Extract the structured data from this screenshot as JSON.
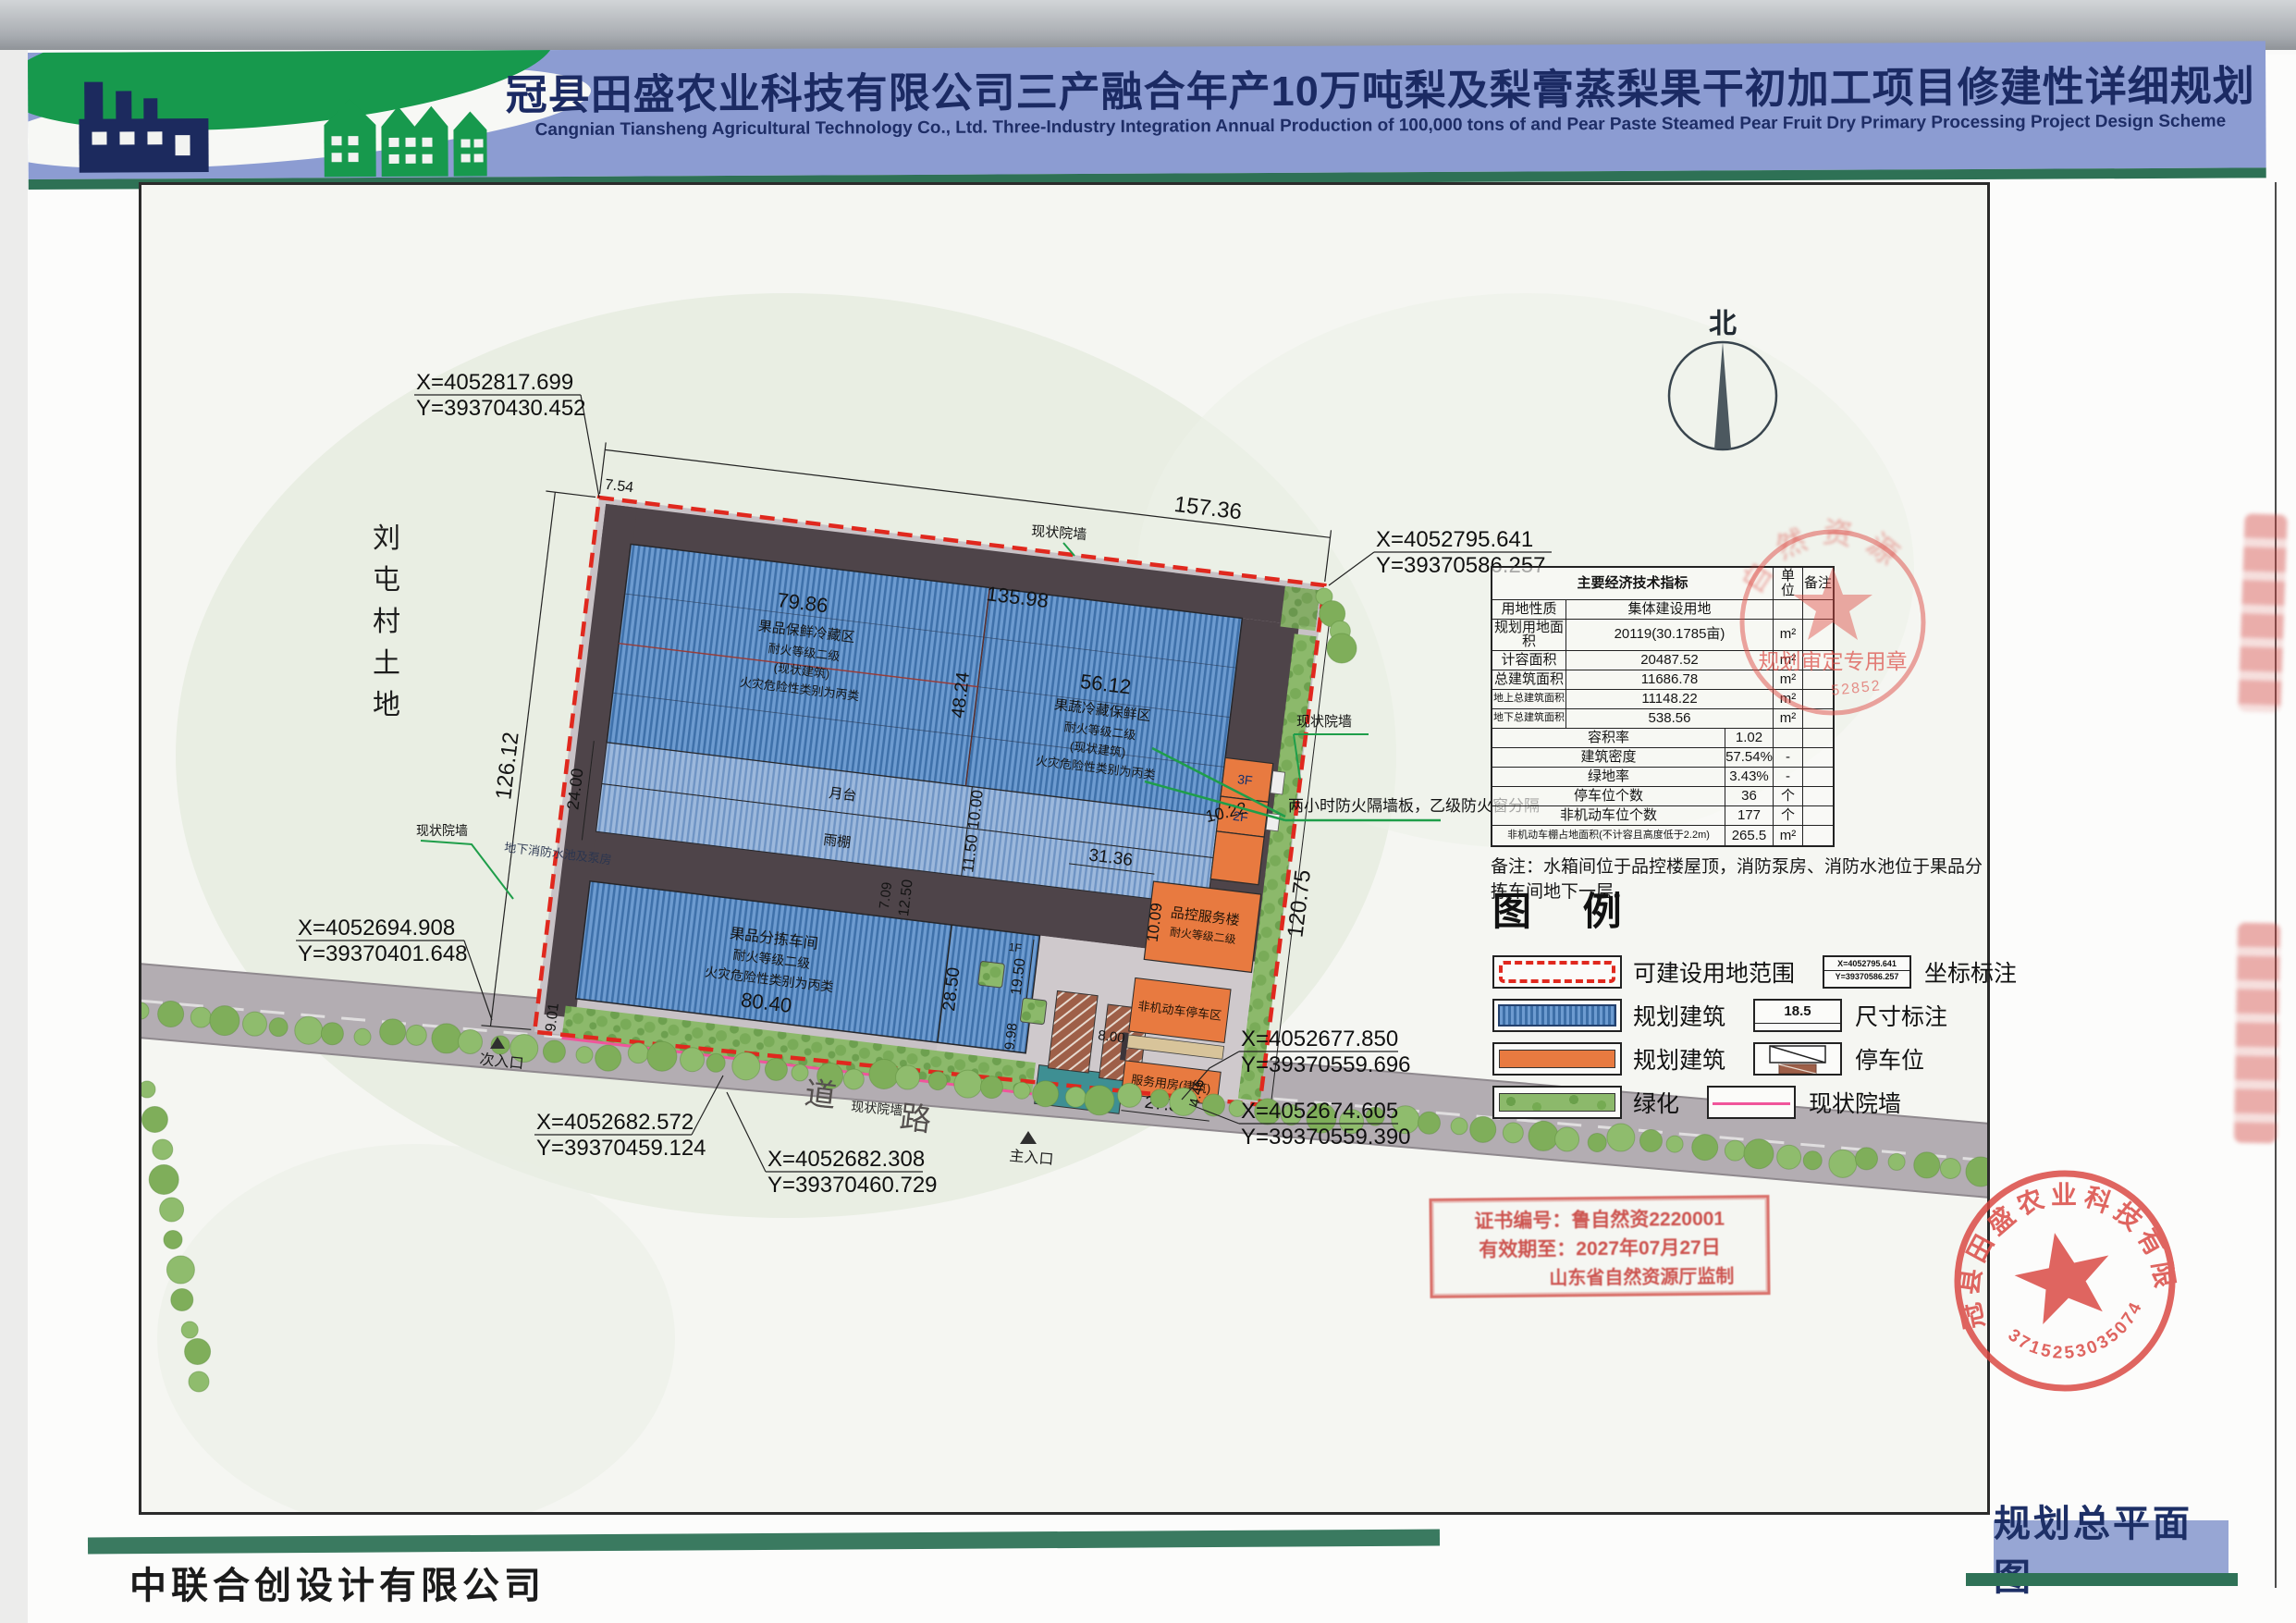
{
  "header": {
    "title": "冠县田盛农业科技有限公司三产融合年产10万吨梨及梨膏蒸梨果干初加工项目修建性详细规划",
    "subtitle": "Cangnian Tiansheng Agricultural Technology Co., Ltd. Three-Industry Integration Annual Production of 100,000 tons of and Pear Paste Steamed Pear Fruit Dry Primary Processing Project Design Scheme"
  },
  "compass": {
    "north": "北"
  },
  "table": {
    "title": "主要经济技术指标",
    "col_unit": "单位",
    "col_note": "备注",
    "rows": [
      {
        "label": "用地性质",
        "value": "集体建设用地",
        "unit": "",
        "note": ""
      },
      {
        "label": "规划用地面积",
        "value": "20119(30.1785亩)",
        "unit": "m²",
        "note": ""
      },
      {
        "label": "计容面积",
        "value": "20487.52",
        "unit": "m²",
        "note": ""
      },
      {
        "label": "总建筑面积",
        "value": "11686.78",
        "unit": "m²",
        "note": ""
      },
      {
        "label": "地上总建筑面积",
        "value": "11148.22",
        "unit": "m²",
        "note": ""
      },
      {
        "label": "地下总建筑面积",
        "value": "538.56",
        "unit": "m²",
        "note": ""
      },
      {
        "label": "容积率",
        "value": "1.02",
        "unit": "",
        "note": ""
      },
      {
        "label": "建筑密度",
        "value": "57.54%",
        "unit": "-",
        "note": ""
      },
      {
        "label": "绿地率",
        "value": "3.43%",
        "unit": "-",
        "note": ""
      },
      {
        "label": "停车位个数",
        "value": "36",
        "unit": "个",
        "note": ""
      },
      {
        "label": "非机动车位个数",
        "value": "177",
        "unit": "个",
        "note": ""
      },
      {
        "label": "非机动车棚占地面积(不计容且高度低于2.2m)",
        "value": "265.5",
        "unit": "m²",
        "note": ""
      }
    ],
    "note": "备注：水箱间位于品控楼屋顶，消防泵房、消防水池位于果品分拣车间地下一层。"
  },
  "legend": {
    "title": "图 例",
    "left": [
      {
        "label": "可建设用地范围"
      },
      {
        "label": "规划建筑"
      },
      {
        "label": "规划建筑"
      },
      {
        "label": "绿化"
      }
    ],
    "right": [
      {
        "label": "坐标标注"
      },
      {
        "label": "尺寸标注"
      },
      {
        "label": "停车位"
      },
      {
        "label": "现状院墙"
      }
    ],
    "coord_x": "X=4052795.641",
    "coord_y": "Y=39370586.257",
    "dim_sample": "18.5"
  },
  "plan": {
    "village_chars": [
      "刘",
      "屯",
      "村",
      "土",
      "地"
    ],
    "road1": "道",
    "road2": "路",
    "entr_main": "主入口",
    "entr_sec": "次入口",
    "wall": "现状院墙",
    "fire_note": "两小时防火隔墙板，乙级防火窗分隔",
    "underground": "地下消防水池及泵房",
    "bA": {
      "l1": "果品保鲜冷藏区",
      "l2": "耐火等级二级",
      "l3": "(现状建筑)",
      "l4": "火灾危险性类别为丙类"
    },
    "bB": {
      "l1": "果蔬冷藏保鲜区",
      "l2": "耐火等级二级",
      "l3": "(现状建筑)",
      "l4": "火灾危险性类别为丙类"
    },
    "bC": {
      "l1": "果品分拣车间",
      "l2": "耐火等级二级",
      "l3": "火灾危险性类别为丙类"
    },
    "qc": {
      "l1": "品控服务楼",
      "l2": "耐火等级二级"
    },
    "f3": "3F",
    "f2": "2F",
    "f1": "1F",
    "platform": "月台",
    "canopy": "雨棚",
    "nonmotor": "非机动车停车区",
    "service": "服务用房(建筑)",
    "dims": {
      "top": "157.36",
      "left": "126.12",
      "right": "120.75",
      "d754": "7.54",
      "a_left": "79.86",
      "a_total": "135.98",
      "a_right": "56.12",
      "a_depth": "48.24",
      "d24": "24.00",
      "d10": "10.00",
      "d115": "11.50",
      "d3136": "31.36",
      "d1022": "10.22",
      "d1009": "10.09",
      "c_w": "80.40",
      "c_d": "28.50",
      "d195": "19.50",
      "d998": "9.98",
      "d901": "9.01",
      "d1250": "12.50",
      "d709": "7.09",
      "d2732": "27.32",
      "d800": "8.00",
      "d446": "4.46"
    },
    "coords": [
      {
        "x": "X=4052817.699",
        "y": "Y=39370430.452"
      },
      {
        "x": "X=4052795.641",
        "y": "Y=39370586.257"
      },
      {
        "x": "X=4052694.908",
        "y": "Y=39370401.648"
      },
      {
        "x": "X=4052682.572",
        "y": "Y=39370459.124"
      },
      {
        "x": "X=4052682.308",
        "y": "Y=39370460.729"
      },
      {
        "x": "X=4052677.850",
        "y": "Y=39370559.696"
      },
      {
        "x": "X=4052674.605",
        "y": "Y=39370559.390"
      }
    ]
  },
  "stamps": {
    "review": {
      "arc": "自然资源",
      "line": "规划审定专用章",
      "digits": "52852"
    },
    "cert": {
      "l1": "证书编号：鲁自然资2220001",
      "l2": "有效期至：2027年07月27日",
      "l3": "山东省自然资源厅监制"
    },
    "company": {
      "name": "冠县田盛农业科技有限公司",
      "number": "3715253035074"
    }
  },
  "footer": {
    "company": "中联合创设计有限公司",
    "sheet_title": "规划总平面图"
  }
}
